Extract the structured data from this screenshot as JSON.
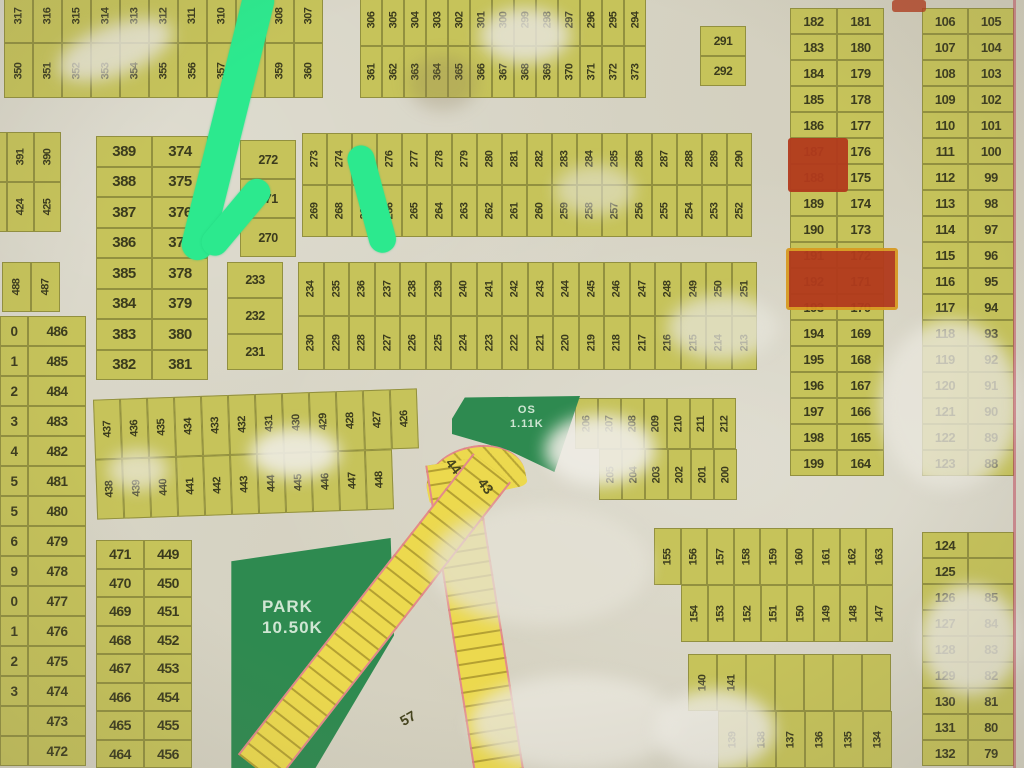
{
  "arrow": {
    "color": "#2ce98e"
  },
  "park": {
    "line1": "PARK",
    "line2": "10.50K"
  },
  "os": {
    "line1": "OS",
    "line2": "1.11K"
  },
  "road": {
    "label_a": "44",
    "label_b": "43",
    "label_c": "57"
  },
  "colors": {
    "plot_fill": "#c6c35a",
    "plot_border": "#92903f",
    "paper": "#d7d4c5",
    "park_green": "#2e8a50",
    "road_yellow": "#ecd94e",
    "highlight_red": "#b23a1c",
    "highlight_ring": "#d89a22",
    "arrow_green": "#2ce98e"
  },
  "blocks": [
    {
      "name": "strip-350",
      "type": "vstrip",
      "x": 4,
      "y": -12,
      "w": 319,
      "h": 110,
      "cellw": 29,
      "fs": 11,
      "top": [
        "317",
        "316",
        "315",
        "314",
        "313",
        "312",
        "311",
        "310",
        "309",
        "308",
        "307"
      ],
      "bottom": [
        "350",
        "351",
        "352",
        "353",
        "354",
        "355",
        "356",
        "357",
        "358",
        "359",
        "360"
      ]
    },
    {
      "name": "strip-306",
      "type": "vstrip",
      "x": 360,
      "y": -6,
      "w": 286,
      "h": 104,
      "cellw": 22,
      "fs": 11,
      "top": [
        "306",
        "305",
        "304",
        "303",
        "302",
        "301",
        "300",
        "299",
        "298",
        "297",
        "296",
        "295",
        "294"
      ],
      "bottom": [
        "361",
        "362",
        "363",
        "364",
        "365",
        "366",
        "367",
        "368",
        "369",
        "370",
        "371",
        "372",
        "373"
      ]
    },
    {
      "name": "block-291",
      "type": "hstack",
      "x": 700,
      "y": 26,
      "w": 46,
      "cellh": 30,
      "fs": 12,
      "cells": [
        "291",
        "292"
      ]
    },
    {
      "name": "col-182",
      "type": "hpairs",
      "x": 790,
      "y": 8,
      "w": 94,
      "rowh": 26,
      "fs": 13,
      "rows": [
        [
          "182",
          "181"
        ],
        [
          "183",
          "180"
        ],
        [
          "184",
          "179"
        ],
        [
          "185",
          "178"
        ],
        [
          "186",
          "177"
        ],
        [
          "187",
          "176"
        ],
        [
          "188",
          "175"
        ],
        [
          "189",
          "174"
        ],
        [
          "190",
          "173"
        ],
        [
          "191",
          "172"
        ],
        [
          "192",
          "171"
        ],
        [
          "193",
          "170"
        ],
        [
          "194",
          "169"
        ],
        [
          "195",
          "168"
        ],
        [
          "196",
          "167"
        ],
        [
          "197",
          "166"
        ],
        [
          "198",
          "165"
        ],
        [
          "199",
          "164"
        ]
      ]
    },
    {
      "name": "col-106",
      "type": "hpairs",
      "x": 922,
      "y": 8,
      "w": 92,
      "rowh": 26,
      "fs": 13,
      "rows": [
        [
          "106",
          "105"
        ],
        [
          "107",
          "104"
        ],
        [
          "108",
          "103"
        ],
        [
          "109",
          "102"
        ],
        [
          "110",
          "101"
        ],
        [
          "111",
          "100"
        ],
        [
          "112",
          "99"
        ],
        [
          "113",
          "98"
        ],
        [
          "114",
          "97"
        ],
        [
          "115",
          "96"
        ],
        [
          "116",
          "95"
        ],
        [
          "117",
          "94"
        ],
        [
          "118",
          "93"
        ],
        [
          "119",
          "92"
        ],
        [
          "120",
          "91"
        ],
        [
          "121",
          "90"
        ],
        [
          "122",
          "89"
        ],
        [
          "123",
          "88"
        ]
      ]
    },
    {
      "name": "block-389",
      "type": "hpairs",
      "x": 96,
      "y": 136,
      "w": 112,
      "rowh": 30.5,
      "fs": 15,
      "rows": [
        [
          "389",
          "374"
        ],
        [
          "388",
          "375"
        ],
        [
          "387",
          "376"
        ],
        [
          "386",
          "377"
        ],
        [
          "385",
          "378"
        ],
        [
          "384",
          "379"
        ],
        [
          "383",
          "380"
        ],
        [
          "382",
          "381"
        ]
      ]
    },
    {
      "name": "edge-391",
      "type": "vstrip",
      "x": -20,
      "y": 132,
      "w": 81,
      "h": 100,
      "cellw": 27,
      "fs": 11,
      "top": [
        "",
        "391",
        "390"
      ],
      "bottom": [
        "",
        "424",
        "425"
      ]
    },
    {
      "name": "edge-488",
      "type": "vstrip",
      "x": 2,
      "y": 262,
      "w": 58,
      "h": 50,
      "cellw": 29,
      "fs": 11,
      "top": [
        "488",
        "487"
      ]
    },
    {
      "name": "col-486",
      "type": "vlist",
      "x": 28,
      "y": 316,
      "w": 58,
      "rowh": 30,
      "fs": 13.5,
      "cells": [
        "486",
        "485",
        "484",
        "483",
        "482",
        "481",
        "480",
        "479",
        "478",
        "477",
        "476",
        "475",
        "474",
        "473",
        "472"
      ]
    },
    {
      "name": "edge-cut-column",
      "type": "vlist",
      "x": 0,
      "y": 316,
      "w": 28,
      "rowh": 30,
      "fs": 13.5,
      "cells": [
        "0",
        "1",
        "2",
        "3",
        "4",
        "5",
        "5",
        "6",
        "9",
        "0",
        "1",
        "2",
        "3",
        "",
        ""
      ]
    },
    {
      "name": "block-437",
      "type": "vstrip",
      "x": 95,
      "y": 394,
      "w": 324,
      "h": 120,
      "cellw": 27,
      "fs": 11,
      "rotate": -2,
      "top": [
        "437",
        "436",
        "435",
        "434",
        "433",
        "432",
        "431",
        "430",
        "429",
        "428",
        "427",
        "426"
      ],
      "bottom": [
        "438",
        "439",
        "440",
        "441",
        "442",
        "443",
        "444",
        "445",
        "446",
        "447",
        "448"
      ]
    },
    {
      "name": "block-272",
      "type": "hstack",
      "x": 240,
      "y": 140,
      "w": 56,
      "cellh": 39,
      "fs": 12.5,
      "cells": [
        "272",
        "271",
        "270"
      ]
    },
    {
      "name": "strip-273",
      "type": "vstrip",
      "x": 302,
      "y": 133,
      "w": 450,
      "h": 104,
      "cellw": 25,
      "fs": 11,
      "top": [
        "273",
        "274",
        "275",
        "276",
        "277",
        "278",
        "279",
        "280",
        "281",
        "282",
        "283",
        "284",
        "285",
        "286",
        "287",
        "288",
        "289",
        "290"
      ],
      "bottom": [
        "269",
        "268",
        "267",
        "266",
        "265",
        "264",
        "263",
        "262",
        "261",
        "260",
        "259",
        "258",
        "257",
        "256",
        "255",
        "254",
        "253",
        "252"
      ]
    },
    {
      "name": "block-233",
      "type": "hstack",
      "x": 227,
      "y": 262,
      "w": 56,
      "cellh": 36,
      "fs": 12.5,
      "cells": [
        "233",
        "232",
        "231"
      ]
    },
    {
      "name": "strip-234",
      "type": "vstrip",
      "x": 298,
      "y": 262,
      "w": 459,
      "h": 108,
      "cellw": 25.5,
      "fs": 11,
      "top": [
        "234",
        "235",
        "236",
        "237",
        "238",
        "239",
        "240",
        "241",
        "242",
        "243",
        "244",
        "245",
        "246",
        "247",
        "248",
        "249",
        "250",
        "251"
      ],
      "bottom": [
        "230",
        "229",
        "228",
        "227",
        "226",
        "225",
        "224",
        "223",
        "222",
        "221",
        "220",
        "219",
        "218",
        "217",
        "216",
        "215",
        "214",
        "213"
      ]
    },
    {
      "name": "block-206",
      "type": "vstrip",
      "x": 575,
      "y": 398,
      "w": 161,
      "h": 102,
      "cellw": 23,
      "fs": 11,
      "bottomOffset": 24,
      "top": [
        "206",
        "207",
        "208",
        "209",
        "210",
        "211",
        "212"
      ],
      "bottom": [
        "205",
        "204",
        "203",
        "202",
        "201",
        "200"
      ]
    },
    {
      "name": "block-155",
      "type": "vstrip",
      "x": 654,
      "y": 528,
      "w": 240,
      "h": 114,
      "cellw": 26.5,
      "fs": 11,
      "bottomOffset": 27,
      "top": [
        "155",
        "156",
        "157",
        "158",
        "159",
        "160",
        "161",
        "162",
        "163"
      ],
      "bottom": [
        "154",
        "153",
        "152",
        "151",
        "150",
        "149",
        "148",
        "147"
      ]
    },
    {
      "name": "block-140",
      "type": "vstrip",
      "x": 688,
      "y": 654,
      "w": 203,
      "h": 114,
      "cellw": 29,
      "fs": 11,
      "bottomOffset": 30,
      "top": [
        "140",
        "141",
        "",
        "",
        "",
        "",
        ""
      ],
      "bottom": [
        "139",
        "138",
        "137",
        "136",
        "135",
        "134"
      ]
    },
    {
      "name": "col-124",
      "type": "hpairs",
      "x": 922,
      "y": 532,
      "w": 92,
      "rowh": 26,
      "fs": 13,
      "rows": [
        [
          "124",
          ""
        ],
        [
          "125",
          ""
        ],
        [
          "126",
          "85"
        ],
        [
          "127",
          "84"
        ],
        [
          "128",
          "83"
        ],
        [
          "129",
          "82"
        ],
        [
          "130",
          "81"
        ],
        [
          "131",
          "80"
        ],
        [
          "132",
          "79"
        ]
      ]
    },
    {
      "name": "col-471",
      "type": "hpairs",
      "x": 96,
      "y": 540,
      "w": 96,
      "rowh": 28.5,
      "fs": 14,
      "rows": [
        [
          "471",
          "449"
        ],
        [
          "470",
          "450"
        ],
        [
          "469",
          "451"
        ],
        [
          "468",
          "452"
        ],
        [
          "467",
          "453"
        ],
        [
          "466",
          "454"
        ],
        [
          "465",
          "455"
        ],
        [
          "464",
          "456"
        ],
        [
          "463",
          "457"
        ]
      ]
    }
  ]
}
